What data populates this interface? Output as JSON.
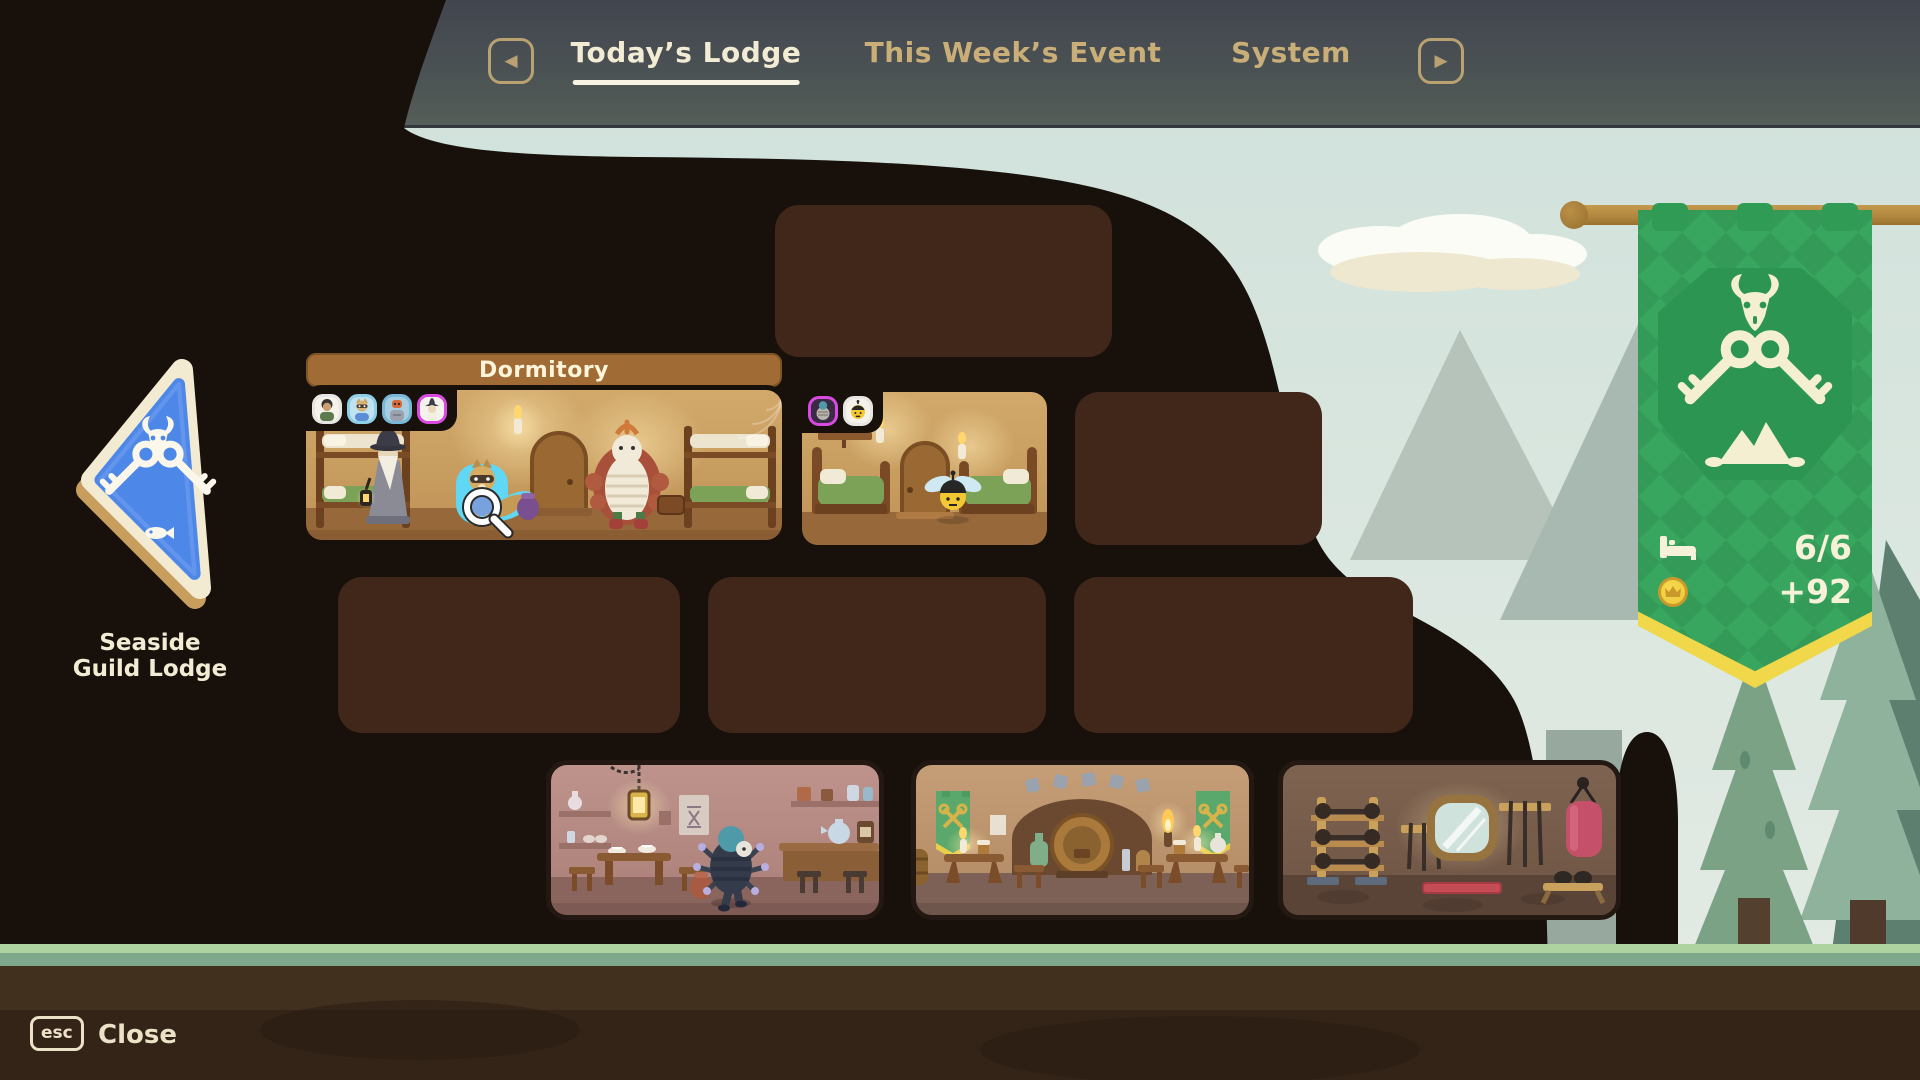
{
  "nav": {
    "prev_arrow": "previous-tab",
    "next_arrow": "next-tab",
    "tabs": [
      {
        "label": "Today’s Lodge",
        "active": true
      },
      {
        "label": "This Week’s Event",
        "active": false
      },
      {
        "label": "System",
        "active": false
      }
    ]
  },
  "guild_badge": {
    "name": "Seaside Guild Lodge",
    "emblem": "crossed-keys-goat-skull-fish"
  },
  "lodge": {
    "dormitory_label": "Dormitory",
    "dormitory_occupants": [
      "villager",
      "cat",
      "robot",
      "wizard"
    ],
    "bedroom_occupants": [
      "spider",
      "bee"
    ],
    "highlighted_character": "raccoon-with-magnifying-glass"
  },
  "banner": {
    "emblem": "crossed-keys-goat-skull-mountain",
    "beds": "6/6",
    "coins": "+92"
  },
  "footer": {
    "key_label": "esc",
    "close_label": "Close"
  },
  "colors": {
    "banner_green": "#38a65f",
    "banner_trim_yellow": "#f0d84a",
    "badge_blue": "#4d87e8",
    "tab_active": "#f3ecd4",
    "tab_inactive": "#c9ae77",
    "room_placeholder": "#40271a",
    "cave_dark": "#17100b"
  }
}
